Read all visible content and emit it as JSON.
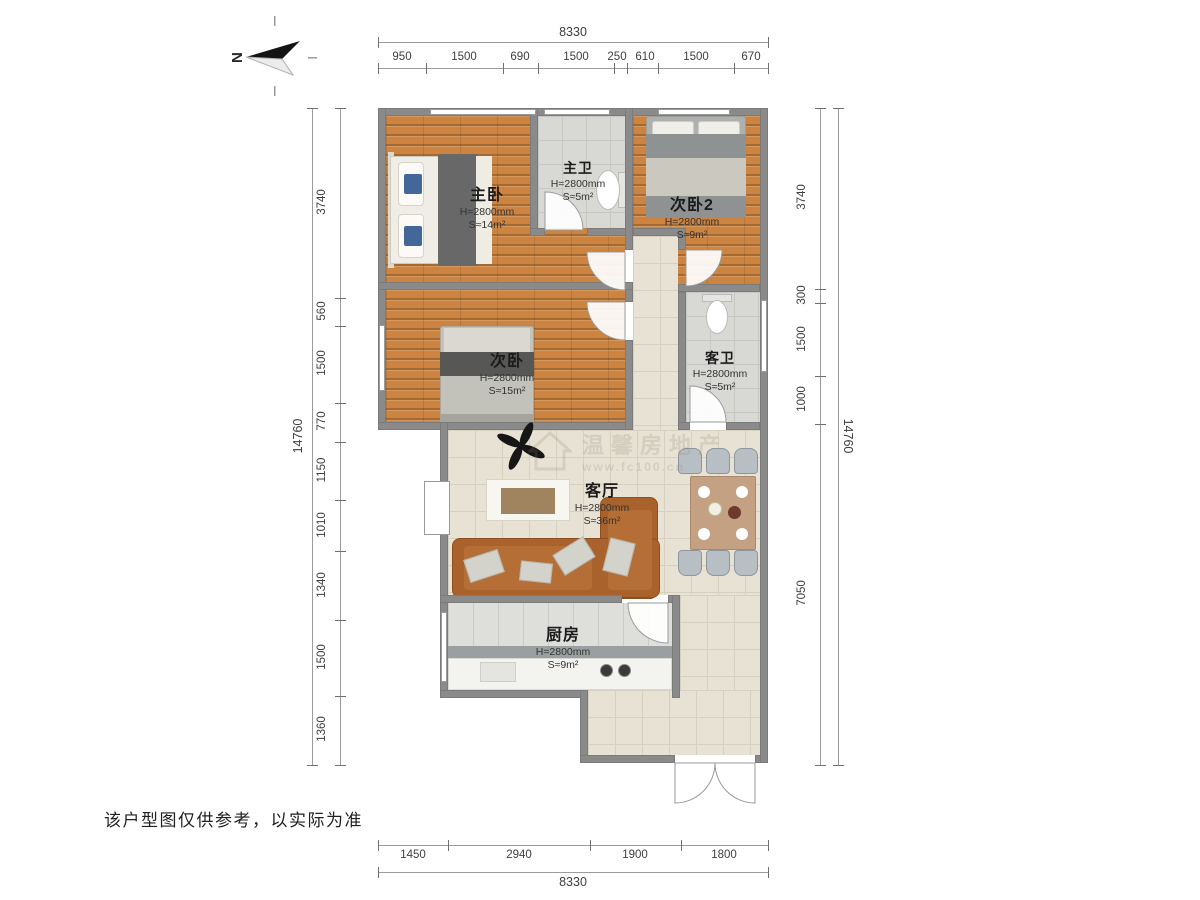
{
  "north": {
    "label": "N"
  },
  "disclaimer": "该户型图仅供参考，以实际为准",
  "watermark": {
    "text_cn": "温馨房地产",
    "text_url": "www.fc100.cn"
  },
  "rooms": [
    {
      "name": "主卧",
      "height": "H=2800mm",
      "area": "S≈14m²"
    },
    {
      "name": "主卫",
      "height": "H=2800mm",
      "area": "S≈5m²"
    },
    {
      "name": "次卧2",
      "height": "H=2800mm",
      "area": "S≈9m²"
    },
    {
      "name": "次卧",
      "height": "H=2800mm",
      "area": "S≈15m²"
    },
    {
      "name": "客卫",
      "height": "H=2800mm",
      "area": "S≈5m²"
    },
    {
      "name": "客厅",
      "height": "H=2800mm",
      "area": "S≈36m²"
    },
    {
      "name": "厨房",
      "height": "H=2800mm",
      "area": "S≈9m²"
    }
  ],
  "dimensions": {
    "top": {
      "total": "8330",
      "segments": [
        "950",
        "1500",
        "690",
        "1500",
        "250",
        "610",
        "1500",
        "670"
      ]
    },
    "bottom": {
      "total": "8330",
      "segments": [
        "1450",
        "2940",
        "1900",
        "1800"
      ]
    },
    "left": {
      "total": "14760",
      "segments": [
        "3740",
        "560",
        "1500",
        "770",
        "1150",
        "1010",
        "1340",
        "1500",
        "1360"
      ]
    },
    "right": {
      "total": "14760",
      "segments": [
        "3740",
        "300",
        "1500",
        "1000",
        "7050"
      ]
    }
  },
  "colors": {
    "wall": "#8a8a8a",
    "wood_floor": "#cd8440",
    "bath_tile": "#d8d8d5",
    "living_tile": "#e8e2d5",
    "sofa": "#a9622c",
    "pillow_blue": "#44679a"
  }
}
